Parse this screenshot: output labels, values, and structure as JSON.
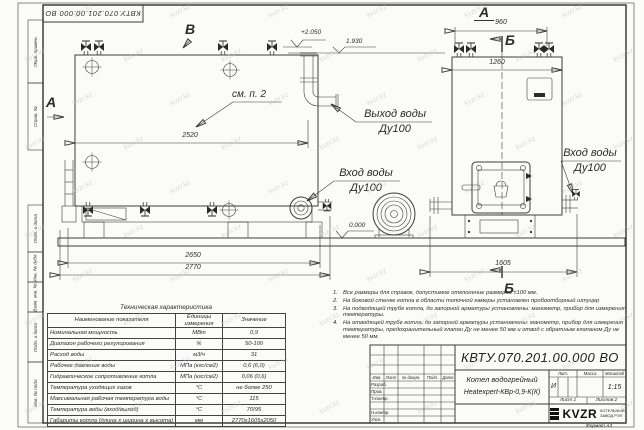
{
  "meta": {
    "sheet_code": "КВТУ.070.201.00.000 ВО",
    "format_note": "Формат А3"
  },
  "watermark": {
    "text": "kvzr.kz"
  },
  "frame": {
    "top_stamp": "КВТУ.070.201.00.000 ВО",
    "side_labels": [
      "Перв. примен.",
      "Справ. №",
      "Подп. и дата",
      "Инв. № дубл.",
      "Взам. инв. №",
      "Подп. и дата",
      "Инв. № подл."
    ]
  },
  "views": {
    "letters": {
      "top_b": "В",
      "top_a": "А",
      "left_a": "А",
      "section_b_top": "Б",
      "section_b_bottom": "Б"
    },
    "labels": {
      "see_note": "см. п. 2",
      "outlet_line1": "Выход воды",
      "outlet_line2": "Ду100",
      "inlet_line1": "Вход воды",
      "inlet_line2": "Ду100",
      "inlet_right_line1": "Вход воды",
      "inlet_right_line2": "Ду100"
    },
    "elevations": {
      "top": "+2.050",
      "outlet": "1.930",
      "zero": "0.000"
    },
    "dims": {
      "d2520": "2520",
      "d2650": "2650",
      "d2770": "2770",
      "d960": "960",
      "d1260": "1260",
      "d1605": "1605"
    }
  },
  "tech_table": {
    "title": "Техническая характеристика",
    "headers": [
      "Наименование показателя",
      "Единицы измерения",
      "Значение"
    ],
    "rows": [
      [
        "Номинальная мощность",
        "МВт",
        "0,9"
      ],
      [
        "Диапазон рабочего регулирования",
        "%",
        "50-100"
      ],
      [
        "Расход воды",
        "м3/ч",
        "31"
      ],
      [
        "Рабочее давление воды",
        "МПа (кгс/см2)",
        "0,6 (6,0)"
      ],
      [
        "Гидравлическое сопротивление котла",
        "МПа (кгс/см2)",
        "0,06 (0,6)"
      ],
      [
        "Температура уходящих газов",
        "°С",
        "не более 250"
      ],
      [
        "Максимальная рабочая температура воды",
        "°С",
        "115"
      ],
      [
        "Температура воды (вход/выход)",
        "°С",
        "70/95"
      ],
      [
        "Габариты котла (длина х ширина х высота)",
        "мм",
        "2770х1605х2050"
      ]
    ]
  },
  "notes": {
    "items": [
      "Все размеры для справок, допустимое отклонение размеров ±100 мм.",
      "На боковой стенке котла в области топочной камеры установлен пробоотборный штуцер",
      "На подводящей трубе котла, до запорной арматуры установлены: манометр, прибор для измерения температуры.",
      "На отводящей трубе котла, до запорной арматуры установлены: манометр, прибор для измерения температуры, предохранительный клапан Ду не менее 50 мм и отвод с обратным клапаном Ду не менее 50 мм."
    ]
  },
  "title_block": {
    "designation": "КВТУ.070.201.00.000 ВО",
    "name_line1": "Котел водогрейный",
    "name_line2": "Heatexpert-КВр-0,9-К(К)",
    "header_cols": [
      "Изм.",
      "Лист",
      "№ докум.",
      "Подп.",
      "Дата"
    ],
    "rows": [
      "Разраб.",
      "Пров.",
      "Т.контр.",
      "",
      "Н.контр.",
      "Утв."
    ],
    "lit_label": "Лит.",
    "mass_label": "Масса",
    "scale_label": "Масштаб",
    "lit_value": "И",
    "scale_value": "1:15",
    "sheet_label": "Лист 1",
    "sheets_label": "Листов 2",
    "logo_word": "KVZR",
    "company_line1": "КОТЕЛЬНЫЙ",
    "company_line2": "ЗАВОД РЭП",
    "format_note": "Формат А3"
  }
}
